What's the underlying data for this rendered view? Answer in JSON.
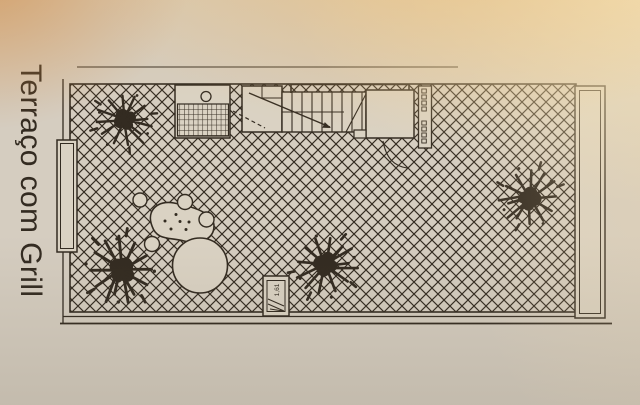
{
  "photo": {
    "description": "Photograph of a printed architectural floor plan on beige paper",
    "title": "Terraço com Grill",
    "plan": {
      "column_marker_label": "1,61",
      "floor_pattern": "diagonal-crosshatch-tiles",
      "feature_names": [
        "grill-counter",
        "sink-burner-circle",
        "grill-grate",
        "stair-landing",
        "staircase",
        "stair-direction-arrow",
        "stair-handrail",
        "roof-block",
        "service-strip",
        "right-ledge",
        "left-planter",
        "round-table",
        "lounge-blob",
        "seat-circles",
        "potted-plant-top-left",
        "potted-plant-bottom-left",
        "potted-plant-bottom-center",
        "potted-plant-right",
        "column-marker"
      ]
    },
    "colors": {
      "paper": "#d5cdc0",
      "paper_fill": "#dad2c3",
      "ink": "#332b21",
      "glare_orange": "#cf8034",
      "glare_gold": "#eeb969",
      "glare_cream": "#fae5b4",
      "shadow": "#69604b"
    }
  }
}
